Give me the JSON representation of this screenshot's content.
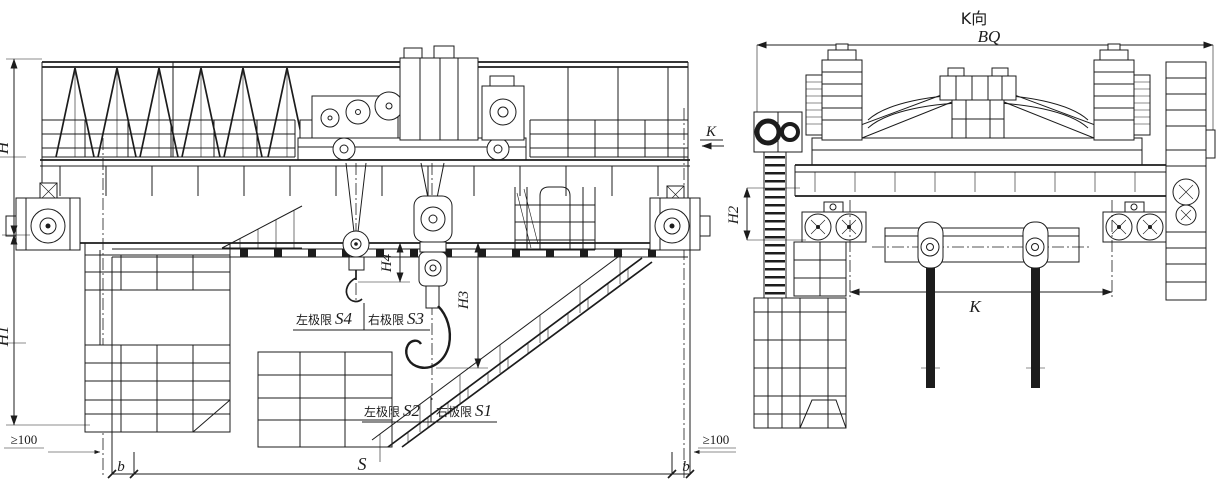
{
  "colors": {
    "ink": "#1c1c1c",
    "paper": "#ffffff"
  },
  "views": {
    "front_elevation": {
      "dimensions": {
        "total_height": "H",
        "lower_height": "H1",
        "aux_hook_lift": "H4",
        "main_hook_lift": "H3",
        "span": "S",
        "rail_margin_left": "b",
        "rail_margin_right": "b",
        "min_clearance_left": "≥100",
        "min_clearance_right": "≥100"
      },
      "view_arrow": {
        "label": "K"
      },
      "hook_limits": {
        "aux": {
          "left_label": "左极限",
          "left_value": "S4",
          "right_label": "右极限",
          "right_value": "S3"
        },
        "main": {
          "left_label": "左极限",
          "left_value": "S2",
          "right_label": "右极限",
          "right_value": "S1"
        }
      }
    },
    "side_view": {
      "title": "K向",
      "dimensions": {
        "overall_width": "BQ",
        "buffer_height": "H2",
        "trolley_gauge": "K"
      }
    }
  }
}
